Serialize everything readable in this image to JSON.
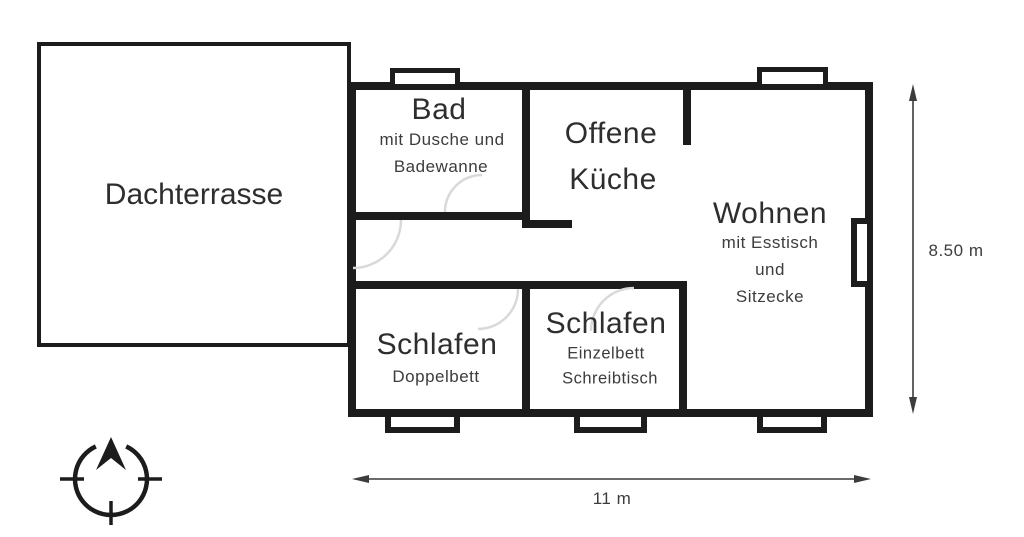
{
  "plan": {
    "terrace": {
      "label": "Dachterrasse"
    },
    "bathroom": {
      "label": "Bad",
      "details": [
        "mit Dusche und",
        "Badewanne"
      ]
    },
    "kitchen": {
      "label_line1": "Offene",
      "label_line2": "Küche"
    },
    "living": {
      "label": "Wohnen",
      "details": [
        "mit Esstisch",
        "und",
        "Sitzecke"
      ]
    },
    "bedroom_double": {
      "label": "Schlafen",
      "details": [
        "Doppelbett"
      ]
    },
    "bedroom_single": {
      "label": "Schlafen",
      "details": [
        "Einzelbett",
        "Schreibtisch"
      ]
    }
  },
  "dimensions": {
    "height": "8.50 m",
    "width": "11 m"
  },
  "icons": {
    "compass": "compass-north-arrow-icon"
  },
  "colors": {
    "wall": "#1c1c1c",
    "text": "#2e2e2e",
    "door_arc": "#d9d9d9",
    "dimension": "#3c3c3c",
    "background": "#ffffff"
  }
}
